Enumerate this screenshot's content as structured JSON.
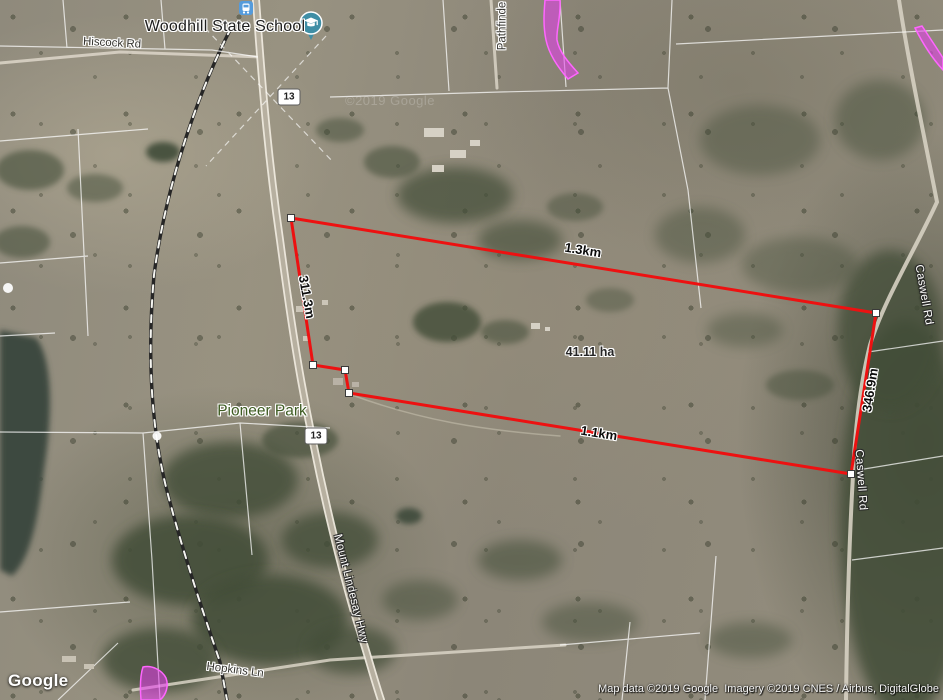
{
  "map": {
    "tile_watermark": "©2019 Google"
  },
  "poi": {
    "school_label": "Woodhill State School",
    "park_label": "Pioneer Park"
  },
  "roads": {
    "hiscock": "Hiscock Rd",
    "pathfinder": "Pathfinde",
    "mount_lindesay": "Mount Lindesay Hwy",
    "caswell_upper": "Caswell Rd",
    "caswell_lower": "Caswell Rd",
    "hopkins": "Hopkins Ln",
    "shield_top": "13",
    "shield_bottom": "13"
  },
  "measurements": {
    "top_edge": "1.3km",
    "bottom_edge": "1.1km",
    "left_edge": "311.3m",
    "right_edge": "346.9m",
    "area": "41.11 ha"
  },
  "footer": {
    "logo": "Google",
    "attribution": "Map data ©2019 Google  Imagery ©2019 CNES / Airbus, DigitalGlobe"
  },
  "colors": {
    "boundary": "#ed1111",
    "selection": "#e93cf0",
    "park_text": "#3e5c22"
  }
}
